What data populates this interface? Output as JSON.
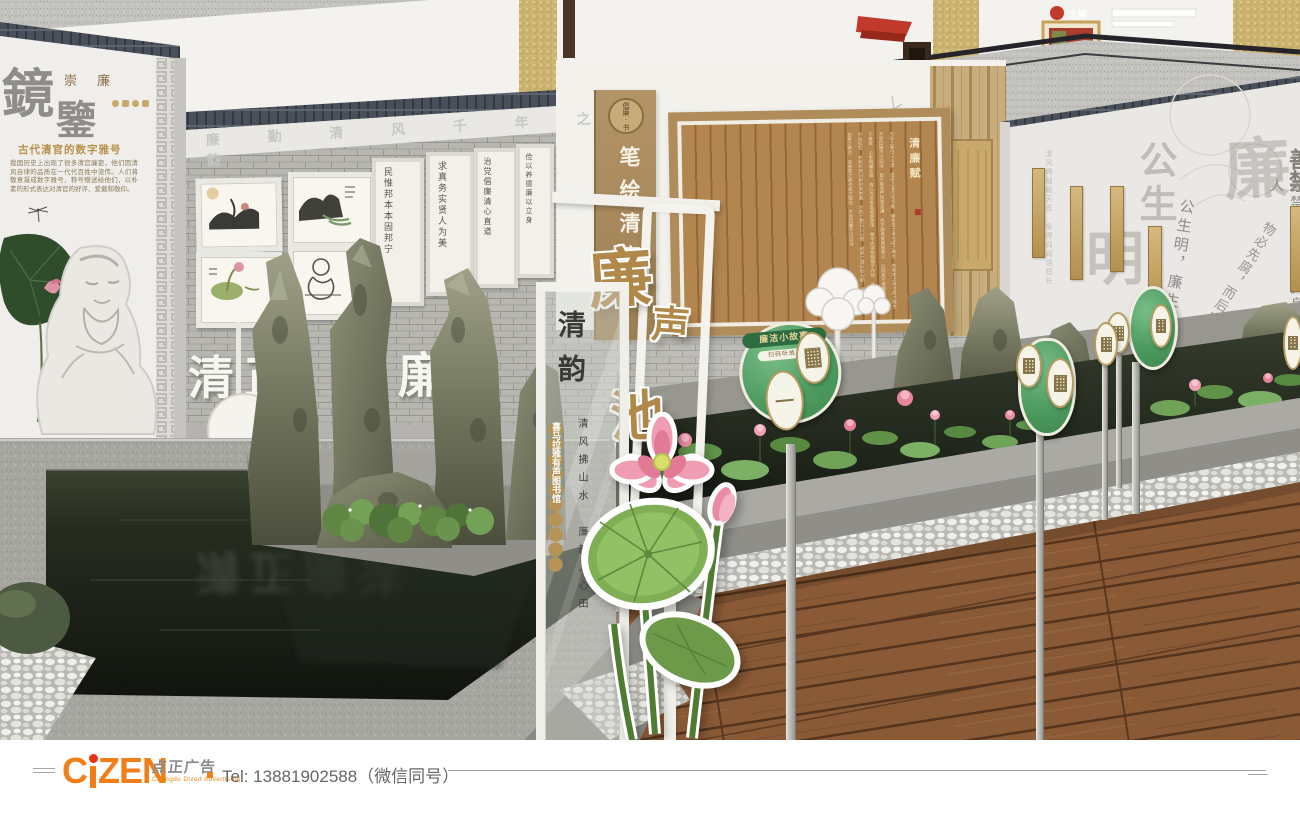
{
  "mezzanine": {
    "banner_title": "之路"
  },
  "left_wall": {
    "title_char1": "鏡",
    "title_char2": "鑒",
    "subtitle": "崇 廉",
    "heading": "古代清官的数字雅号",
    "paragraph": "我国历史上出现了很多清官廉吏，他们因清风自律的品质在一代代百姓中流传。人们将敬意凝成数字雅号、称号赠送给他们，以朴素的形式表达对清官的好评、爱戴和敬仰。",
    "frieze": "廉 勤 清 风 千 年 之 韵"
  },
  "gallery": {
    "scroll1": "民惟邦本本固邦宁",
    "scroll2": "求真务实贤人为美",
    "scroll3": "治党倡廉清心直道",
    "scroll4": "俭以养德廉以立身",
    "big_chars": "清正",
    "big_char_hidden": "廉"
  },
  "center_wall": {
    "pilaster_badge": "倡廉·书",
    "pilaster_text": "笔绘清廉",
    "board_title": "清廉赋",
    "board_body": "为政之要曰公与清 成家之道曰俭与勤 廉者政之本也民之表也 贪者政之祸也民之贼也 不受曰廉不污曰洁 吏不畏吾严而畏吾廉 民不服吾能而服吾公 公则民不敢慢 廉则吏不敢欺 公生明廉生威 清心为治本直道是身谋 秀干终成栋精钢不作钩 仓充鼠雀喜草尽兔狐愁 史册有遗训毋贻来者羞 为政之要曰公与清 成家之道曰俭与勤 廉者政之本也民之表也 贪者政之祸也民之贼也 不受曰廉不污曰洁"
  },
  "stand": {
    "sign_char1": "廉",
    "sign_char2": "声",
    "sign_char3": "池",
    "glass_title": "清韵",
    "medallions": "喜马拉雅有声图书馆",
    "poem": "清风拂山水　廉韵入心田"
  },
  "right_wall": {
    "watermark_top": "公生",
    "watermark_ming": "明",
    "watermark_lian": "廉",
    "corner_chars": "善禁",
    "quote1": "公生明，廉生威。",
    "quote2": "善禁者，先禁其身而后人",
    "quote3": "物必先腐，而后虫生",
    "faint_text": "清风两袖朝天去 免得闾阎话短长"
  },
  "pond_signs": {
    "title": "廉洁小故事",
    "subtitle": "扫码听故事"
  },
  "reflection": {
    "chars": "清正廉洁"
  },
  "footer": {
    "brand_c": "C",
    "brand_rest": "ZEN",
    "brand_cn": "点正广告",
    "brand_sub": "Chengdu Dized Advertising",
    "tel": "Tel: 13881902588（微信同号）"
  }
}
